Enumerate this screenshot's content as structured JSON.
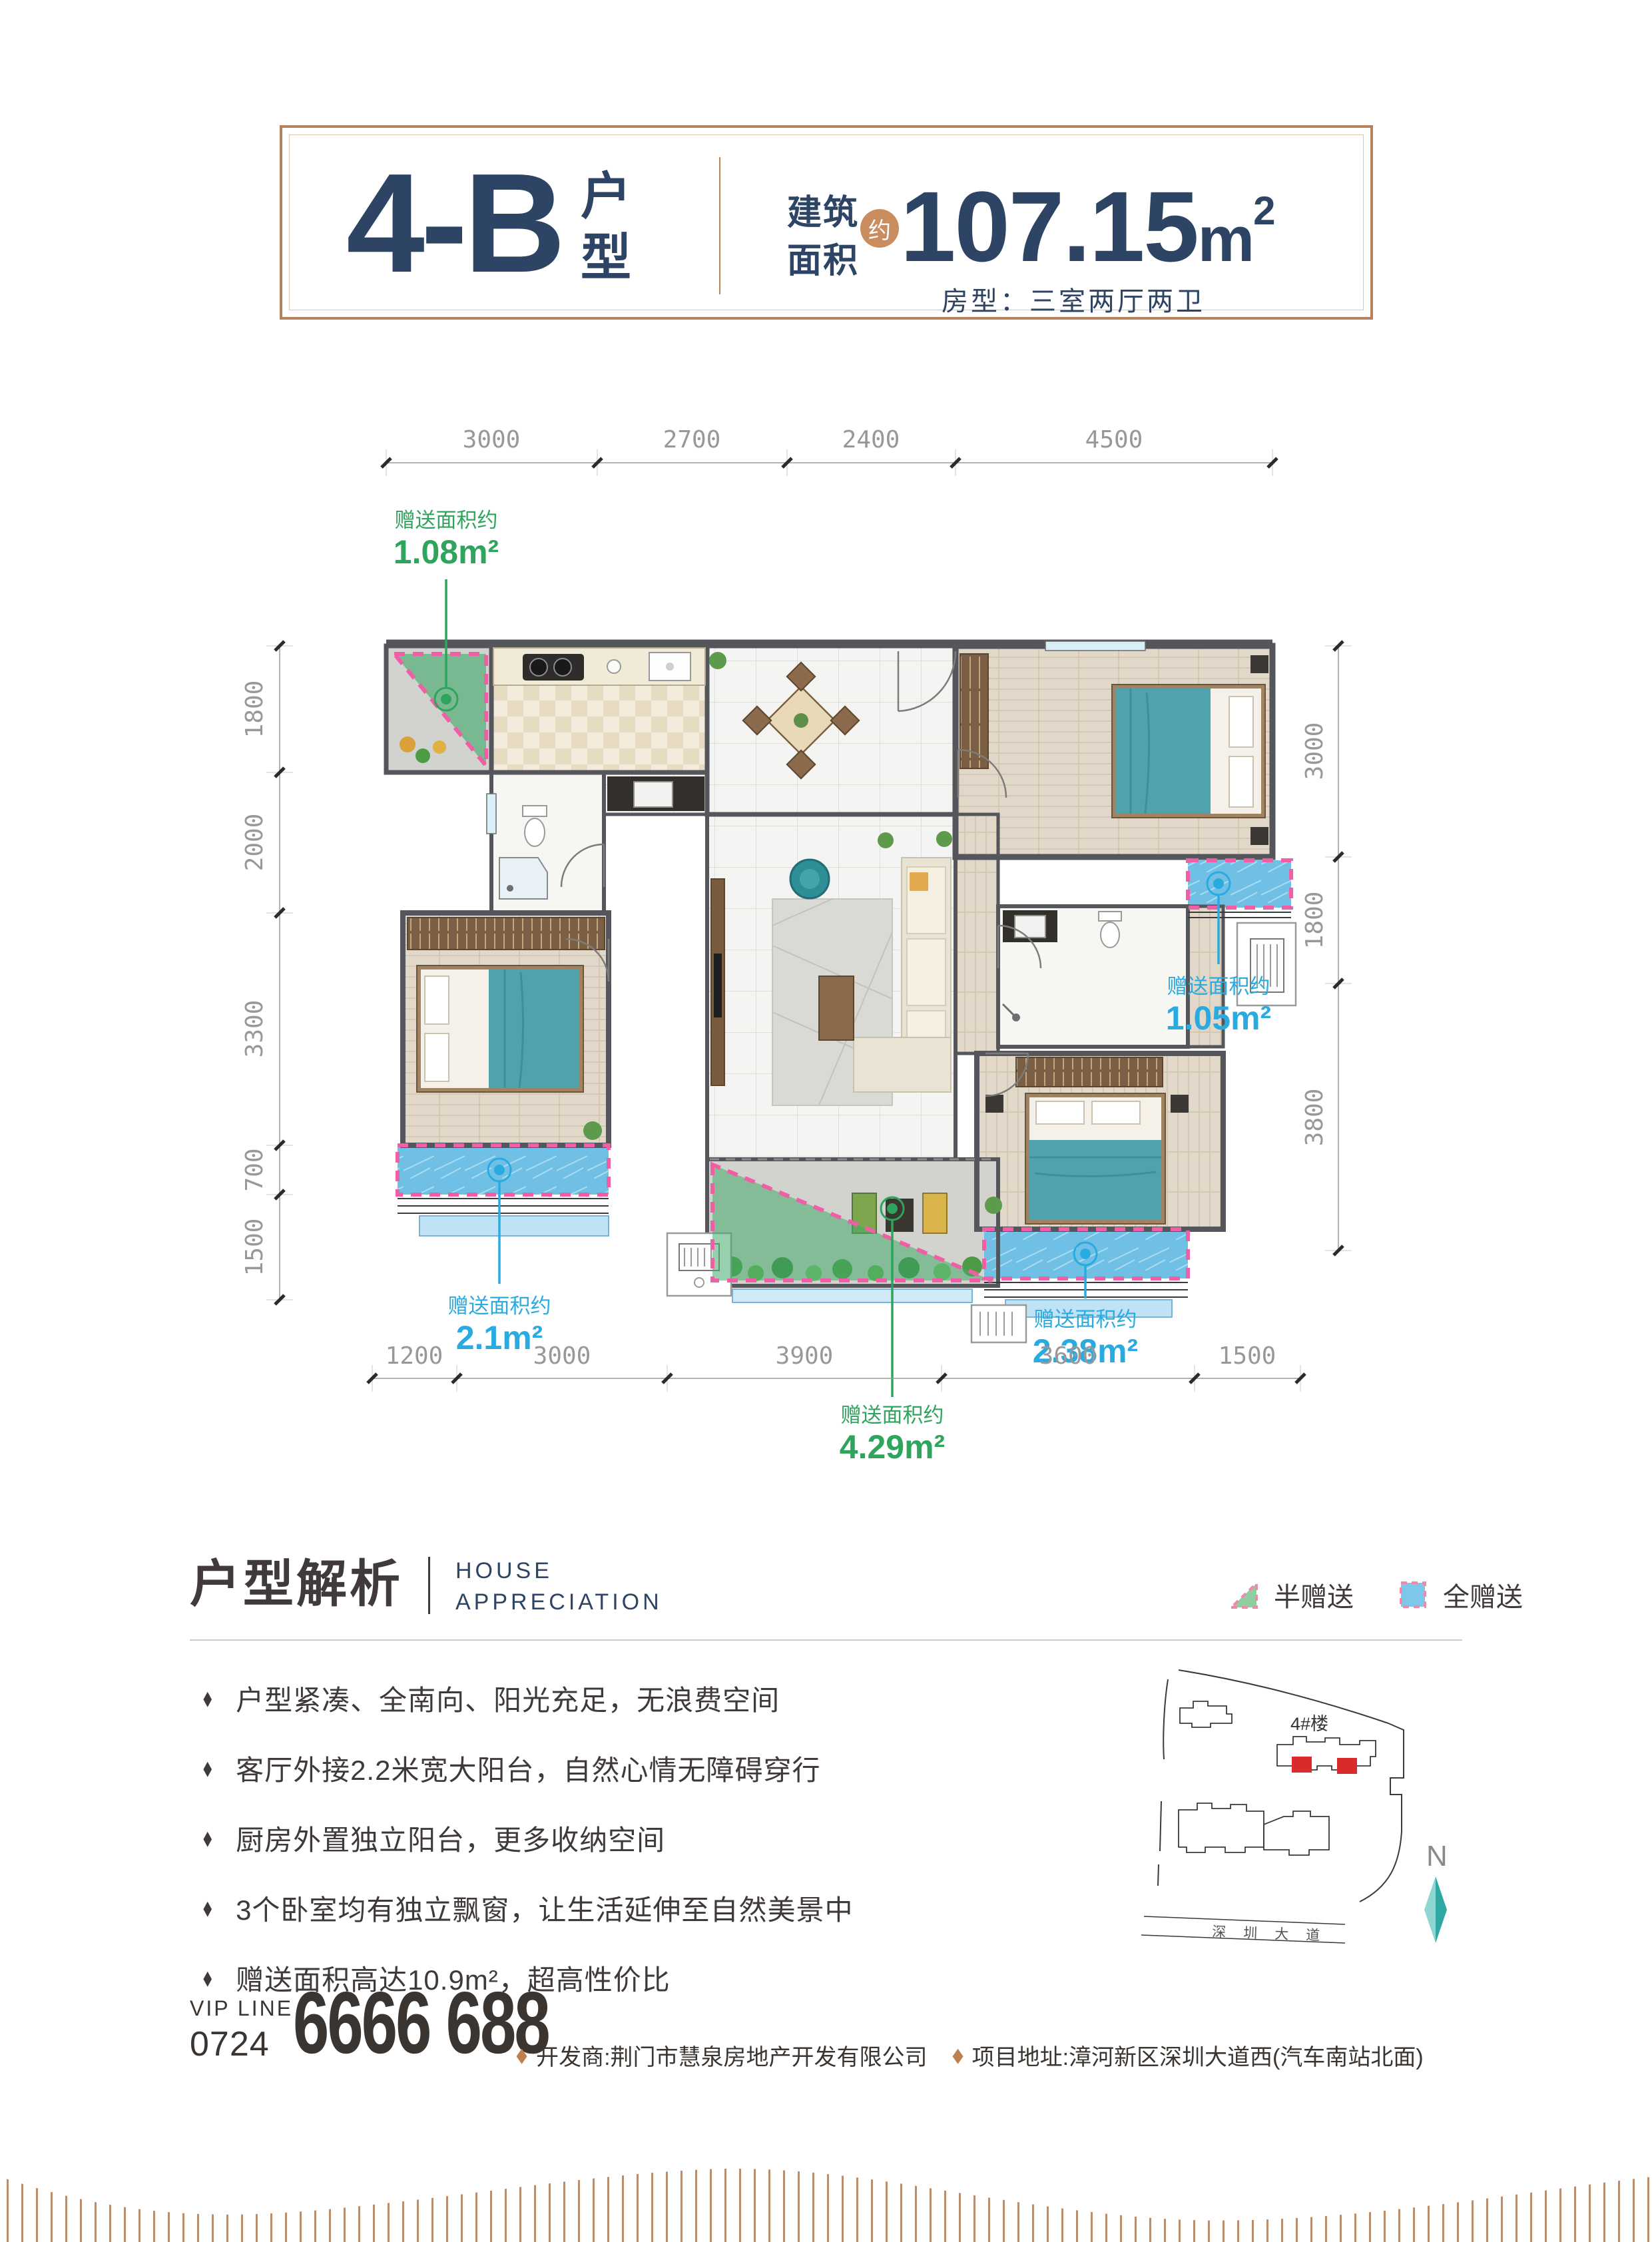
{
  "title_box": {
    "unit": "4-B",
    "unit_suffix": "户型",
    "area_label_top": "建筑",
    "area_label_bottom": "面积",
    "area_approx": "约",
    "area_value": "107.15",
    "area_unit": "m",
    "area_sup": "2",
    "room_type": "房型：三室两厅两卫"
  },
  "plan": {
    "dims": {
      "top": [
        "3000",
        "2700",
        "2400",
        "4500"
      ],
      "bottom": [
        "1200",
        "3000",
        "3900",
        "3600",
        "1500"
      ],
      "left": [
        "1800",
        "2000",
        "3300",
        "700",
        "1500"
      ],
      "right": [
        "3000",
        "1800",
        "3800"
      ]
    },
    "gifts": [
      {
        "label": "赠送面积约",
        "value": "1.08m²",
        "type": "half",
        "color": "#2fa45c"
      },
      {
        "label": "赠送面积约",
        "value": "1.05m²",
        "type": "full",
        "color": "#29abe2"
      },
      {
        "label": "赠送面积约",
        "value": "2.1m²",
        "type": "full",
        "color": "#29abe2"
      },
      {
        "label": "赠送面积约",
        "value": "4.29m²",
        "type": "half",
        "color": "#2fa45c"
      },
      {
        "label": "赠送面积约",
        "value": "2.38m²",
        "type": "full",
        "color": "#29abe2"
      }
    ]
  },
  "analysis": {
    "title_cn": "户型解析",
    "title_en_line1": "HOUSE",
    "title_en_line2": "APPRECIATION",
    "legend": [
      {
        "label": "半赠送",
        "color": "#8fcf9f"
      },
      {
        "label": "全赠送",
        "color": "#7cc7ea"
      }
    ],
    "bullets": [
      "户型紧凑、全南向、阳光充足，无浪费空间",
      "客厅外接2.2米宽大阳台，自然心情无障碍穿行",
      "厨房外置独立阳台，更多收纳空间",
      "3个卧室均有独立飘窗，让生活延伸至自然美景中",
      "赠送面积高达10.9m²，超高性价比"
    ]
  },
  "sitemap": {
    "building_label": "4#楼",
    "road_label": "深圳大道",
    "compass": "N"
  },
  "footer": {
    "vip_line_label": "VIP LINE",
    "vip_area_code": "0724",
    "vip_number": "6666 688",
    "developer": "开发商:荆门市慧泉房地产开发有限公司",
    "address": "项目地址:漳河新区深圳大道西(汽车南站北面)"
  },
  "colors": {
    "accent_copper": "#b5825c",
    "navy": "#2e4464",
    "gift_green": "#2fa45c",
    "gift_blue": "#29abe2",
    "dashed_pink": "#f05fa5",
    "unit_red": "#d92b2b",
    "furniture_teal": "#4fa3ad"
  }
}
